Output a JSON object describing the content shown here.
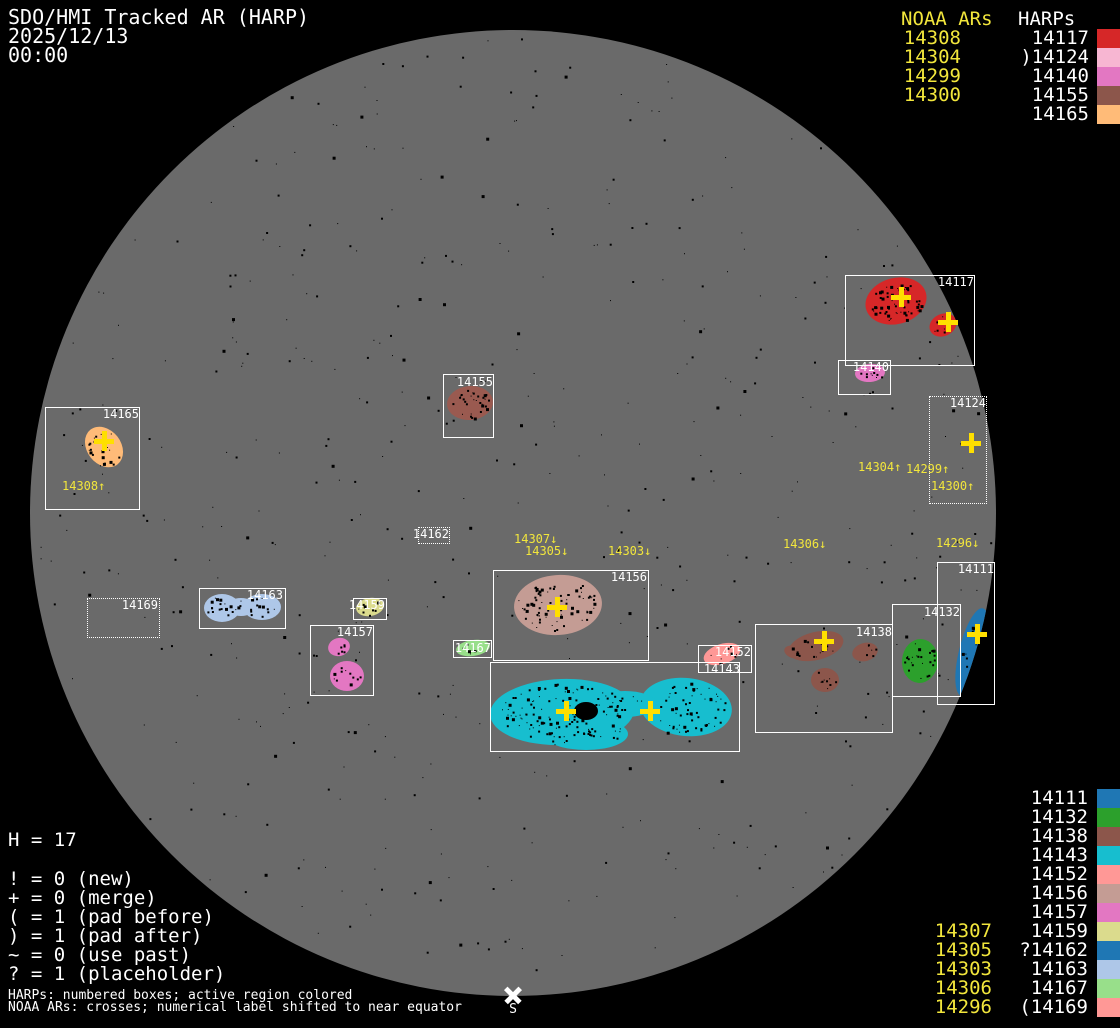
{
  "title": {
    "line1": "SDO/HMI Tracked AR (HARP)",
    "date": "2025/12/13",
    "time": "00:00"
  },
  "colors": {
    "background": "#000000",
    "disk": "#6a6a6a",
    "box_border": "#ffffff",
    "label_text": "#ffffff",
    "noaa_yellow": "#f2e63c",
    "cross_yellow": "#ffdf00",
    "speckle": "#000000",
    "south_marker": "#ffffff"
  },
  "top_right": {
    "noaa_header": "NOAA ARs",
    "harp_header": "HARPs",
    "rows": [
      {
        "noaa": "14308",
        "prefix": "",
        "harp": "14117",
        "color": "#d62728"
      },
      {
        "noaa": "14304",
        "prefix": ")",
        "harp": "14124",
        "color": "#f7b6d2"
      },
      {
        "noaa": "14299",
        "prefix": "",
        "harp": "14140",
        "color": "#e377c2"
      },
      {
        "noaa": "14300",
        "prefix": "",
        "harp": "14155",
        "color": "#8c564b"
      },
      {
        "noaa": "",
        "prefix": "",
        "harp": "14165",
        "color": "#ffbb78"
      }
    ]
  },
  "bottom_right": {
    "rows": [
      {
        "noaa": "",
        "prefix": "",
        "harp": "14111",
        "color": "#1f77b4"
      },
      {
        "noaa": "",
        "prefix": "",
        "harp": "14132",
        "color": "#2ca02c"
      },
      {
        "noaa": "",
        "prefix": "",
        "harp": "14138",
        "color": "#8c564b"
      },
      {
        "noaa": "",
        "prefix": "",
        "harp": "14143",
        "color": "#17becf"
      },
      {
        "noaa": "",
        "prefix": "",
        "harp": "14152",
        "color": "#ff9896"
      },
      {
        "noaa": "",
        "prefix": "",
        "harp": "14156",
        "color": "#c49c94"
      },
      {
        "noaa": "",
        "prefix": "",
        "harp": "14157",
        "color": "#e377c2"
      },
      {
        "noaa": "14307",
        "prefix": "",
        "harp": "14159",
        "color": "#dbdb8d"
      },
      {
        "noaa": "14305",
        "prefix": "?",
        "harp": "14162",
        "color": "#1f77b4"
      },
      {
        "noaa": "14303",
        "prefix": "",
        "harp": "14163",
        "color": "#aec7e8"
      },
      {
        "noaa": "14306",
        "prefix": "",
        "harp": "14167",
        "color": "#98df8a"
      },
      {
        "noaa": "14296",
        "prefix": "(",
        "harp": "14169",
        "color": "#ff9896"
      }
    ]
  },
  "legend": {
    "h_count": "H = 17",
    "lines": [
      "! = 0 (new)",
      "+ = 0 (merge)",
      "( = 1 (pad before)",
      ") = 1 (pad after)",
      "~ = 0 (use past)",
      "? = 1 (placeholder)"
    ]
  },
  "footnotes": {
    "harps": "HARPs: numbered boxes; active region colored",
    "noaa": "NOAA ARs: crosses; numerical label shifted to near equator"
  },
  "south_marker": {
    "label": "S",
    "x": 513,
    "y": 995
  },
  "chart_data": {
    "type": "scatter",
    "title": "SDO/HMI Tracked AR (HARP)",
    "subtitle": "2025/12/13 00:00",
    "disk": {
      "cx": 513,
      "cy": 513,
      "r": 483
    },
    "disk_speckles": 520,
    "regions": [
      {
        "id": "14117",
        "box": [
          845,
          275,
          130,
          91
        ],
        "style": "solid",
        "label_right": 974,
        "label_top": 276,
        "color": "#d62728",
        "blobs": [
          {
            "cx": 896,
            "cy": 301,
            "rx": 31,
            "ry": 23,
            "rot": -15,
            "dots": 60
          },
          {
            "cx": 943,
            "cy": 325,
            "rx": 14,
            "ry": 11,
            "rot": -25,
            "dots": 6
          }
        ]
      },
      {
        "id": "14140",
        "box": [
          838,
          360,
          53,
          35
        ],
        "style": "solid",
        "label_right": 889,
        "label_top": 361,
        "color": "#e377c2",
        "blobs": [
          {
            "cx": 870,
            "cy": 373,
            "rx": 15,
            "ry": 9,
            "rot": -5,
            "dots": 10
          }
        ]
      },
      {
        "id": "14124",
        "box": [
          929,
          396,
          58,
          108
        ],
        "style": "dotted",
        "label_right": 986,
        "label_top": 397,
        "color": null,
        "blobs": []
      },
      {
        "id": "14165",
        "box": [
          45,
          407,
          95,
          103
        ],
        "style": "solid",
        "label_right": 139,
        "label_top": 408,
        "color": "#ffbb78",
        "blobs": [
          {
            "cx": 104,
            "cy": 447,
            "rx": 17,
            "ry": 22,
            "rot": -38,
            "dots": 22
          }
        ]
      },
      {
        "id": "14155",
        "box": [
          443,
          374,
          51,
          64
        ],
        "style": "solid",
        "label_right": 493,
        "label_top": 376,
        "color": "#9a5a50",
        "blobs": [
          {
            "cx": 470,
            "cy": 403,
            "rx": 23,
            "ry": 17,
            "rot": -5,
            "dots": 30
          }
        ]
      },
      {
        "id": "14162",
        "box": [
          418,
          527,
          32,
          17
        ],
        "style": "dotted",
        "label_right": 449,
        "label_top": 528,
        "color": null,
        "blobs": []
      },
      {
        "id": "14169",
        "box": [
          87,
          598,
          73,
          40
        ],
        "style": "dotted",
        "label_right": 158,
        "label_top": 599,
        "color": null,
        "blobs": []
      },
      {
        "id": "14163",
        "box": [
          199,
          588,
          87,
          41
        ],
        "style": "solid",
        "label_right": 283,
        "label_top": 589,
        "color": "#aec7e8",
        "blobs": [
          {
            "cx": 222,
            "cy": 608,
            "rx": 18,
            "ry": 14,
            "rot": 0,
            "dots": 16
          },
          {
            "cx": 262,
            "cy": 607,
            "rx": 19,
            "ry": 13,
            "rot": 0,
            "dots": 14
          },
          {
            "cx": 241,
            "cy": 607,
            "rx": 14,
            "ry": 9,
            "rot": 0,
            "dots": 2
          }
        ]
      },
      {
        "id": "14159",
        "box": [
          353,
          598,
          34,
          22
        ],
        "style": "solid",
        "label_right": 385,
        "label_top": 599,
        "color": "#dbdb8d",
        "blobs": [
          {
            "cx": 370,
            "cy": 607,
            "rx": 14,
            "ry": 9,
            "rot": -10,
            "dots": 8
          }
        ]
      },
      {
        "id": "14157",
        "box": [
          310,
          625,
          64,
          71
        ],
        "style": "solid",
        "label_right": 373,
        "label_top": 626,
        "color": "#e377c2",
        "blobs": [
          {
            "cx": 339,
            "cy": 647,
            "rx": 11,
            "ry": 9,
            "rot": -15,
            "dots": 6
          },
          {
            "cx": 347,
            "cy": 676,
            "rx": 17,
            "ry": 15,
            "rot": 0,
            "dots": 10
          }
        ]
      },
      {
        "id": "14156",
        "box": [
          493,
          570,
          156,
          91
        ],
        "style": "solid",
        "label_right": 647,
        "label_top": 571,
        "color": "#c49c94",
        "blobs": [
          {
            "cx": 558,
            "cy": 605,
            "rx": 44,
            "ry": 30,
            "rot": -4,
            "dots": 75
          }
        ]
      },
      {
        "id": "14152",
        "box": [
          698,
          645,
          54,
          28
        ],
        "style": "solid",
        "label_right": 751,
        "label_top": 646,
        "color": "#ff9896",
        "blobs": [
          {
            "cx": 722,
            "cy": 654,
            "rx": 19,
            "ry": 10,
            "rot": -18,
            "dots": 8
          }
        ]
      },
      {
        "id": "14143",
        "box": [
          490,
          662,
          250,
          90
        ],
        "style": "solid",
        "label_right": 740,
        "label_top": 663,
        "color": "#17becf",
        "blobs": [
          {
            "cx": 562,
            "cy": 712,
            "rx": 72,
            "ry": 33,
            "rot": -2,
            "dots": 120
          },
          {
            "cx": 686,
            "cy": 707,
            "rx": 46,
            "ry": 29,
            "rot": 6,
            "dots": 60
          },
          {
            "cx": 625,
            "cy": 704,
            "rx": 32,
            "ry": 13,
            "rot": 0,
            "dots": 8
          },
          {
            "cx": 586,
            "cy": 734,
            "rx": 42,
            "ry": 16,
            "rot": 0,
            "dots": 15
          }
        ],
        "spots": [
          {
            "cx": 586,
            "cy": 711,
            "rx": 12,
            "ry": 9
          }
        ]
      },
      {
        "id": "14167",
        "box": [
          453,
          640,
          39,
          18
        ],
        "style": "solid",
        "label_right": 491,
        "label_top": 642,
        "color": "#98df8a",
        "blobs": [
          {
            "cx": 473,
            "cy": 648,
            "rx": 17,
            "ry": 8,
            "rot": -8,
            "dots": 6
          }
        ]
      },
      {
        "id": "14138",
        "box": [
          755,
          624,
          138,
          109
        ],
        "style": "solid",
        "label_right": 892,
        "label_top": 626,
        "color": "#8c564b",
        "blobs": [
          {
            "cx": 816,
            "cy": 646,
            "rx": 28,
            "ry": 14,
            "rot": -14,
            "dots": 16
          },
          {
            "cx": 793,
            "cy": 652,
            "rx": 9,
            "ry": 6,
            "rot": 20,
            "dots": 3
          },
          {
            "cx": 865,
            "cy": 652,
            "rx": 13,
            "ry": 9,
            "rot": -15,
            "dots": 6
          },
          {
            "cx": 825,
            "cy": 680,
            "rx": 14,
            "ry": 12,
            "rot": 0,
            "dots": 8
          }
        ]
      },
      {
        "id": "14132",
        "box": [
          892,
          604,
          69,
          93
        ],
        "style": "solid",
        "label_right": 960,
        "label_top": 606,
        "color": "#2ca02c",
        "blobs": [
          {
            "cx": 920,
            "cy": 661,
            "rx": 18,
            "ry": 22,
            "rot": 5,
            "dots": 24
          }
        ]
      },
      {
        "id": "14111",
        "box": [
          937,
          562,
          58,
          143
        ],
        "style": "solid",
        "label_right": 994,
        "label_top": 563,
        "color": "#1f77b4",
        "blobs": [
          {
            "cx": 972,
            "cy": 652,
            "rx": 13,
            "ry": 45,
            "rot": 14,
            "dots": 14
          }
        ]
      }
    ],
    "noaa_crosses": [
      {
        "x": 901,
        "y": 297
      },
      {
        "x": 948,
        "y": 322
      },
      {
        "x": 971,
        "y": 443
      },
      {
        "x": 104,
        "y": 441
      },
      {
        "x": 557,
        "y": 607
      },
      {
        "x": 566,
        "y": 711
      },
      {
        "x": 650,
        "y": 711
      },
      {
        "x": 824,
        "y": 641
      },
      {
        "x": 977,
        "y": 634
      }
    ],
    "noaa_labels": [
      {
        "text": "14308↑",
        "x": 62,
        "y": 480
      },
      {
        "text": "14304↑",
        "x": 858,
        "y": 461
      },
      {
        "text": "14299↑",
        "x": 906,
        "y": 463
      },
      {
        "text": "14300↑",
        "x": 931,
        "y": 480
      },
      {
        "text": "14307↓",
        "x": 514,
        "y": 533
      },
      {
        "text": "14305↓",
        "x": 525,
        "y": 545
      },
      {
        "text": "14303↓",
        "x": 608,
        "y": 545
      },
      {
        "text": "14306↓",
        "x": 783,
        "y": 538
      },
      {
        "text": "14296↓",
        "x": 936,
        "y": 537
      }
    ]
  }
}
